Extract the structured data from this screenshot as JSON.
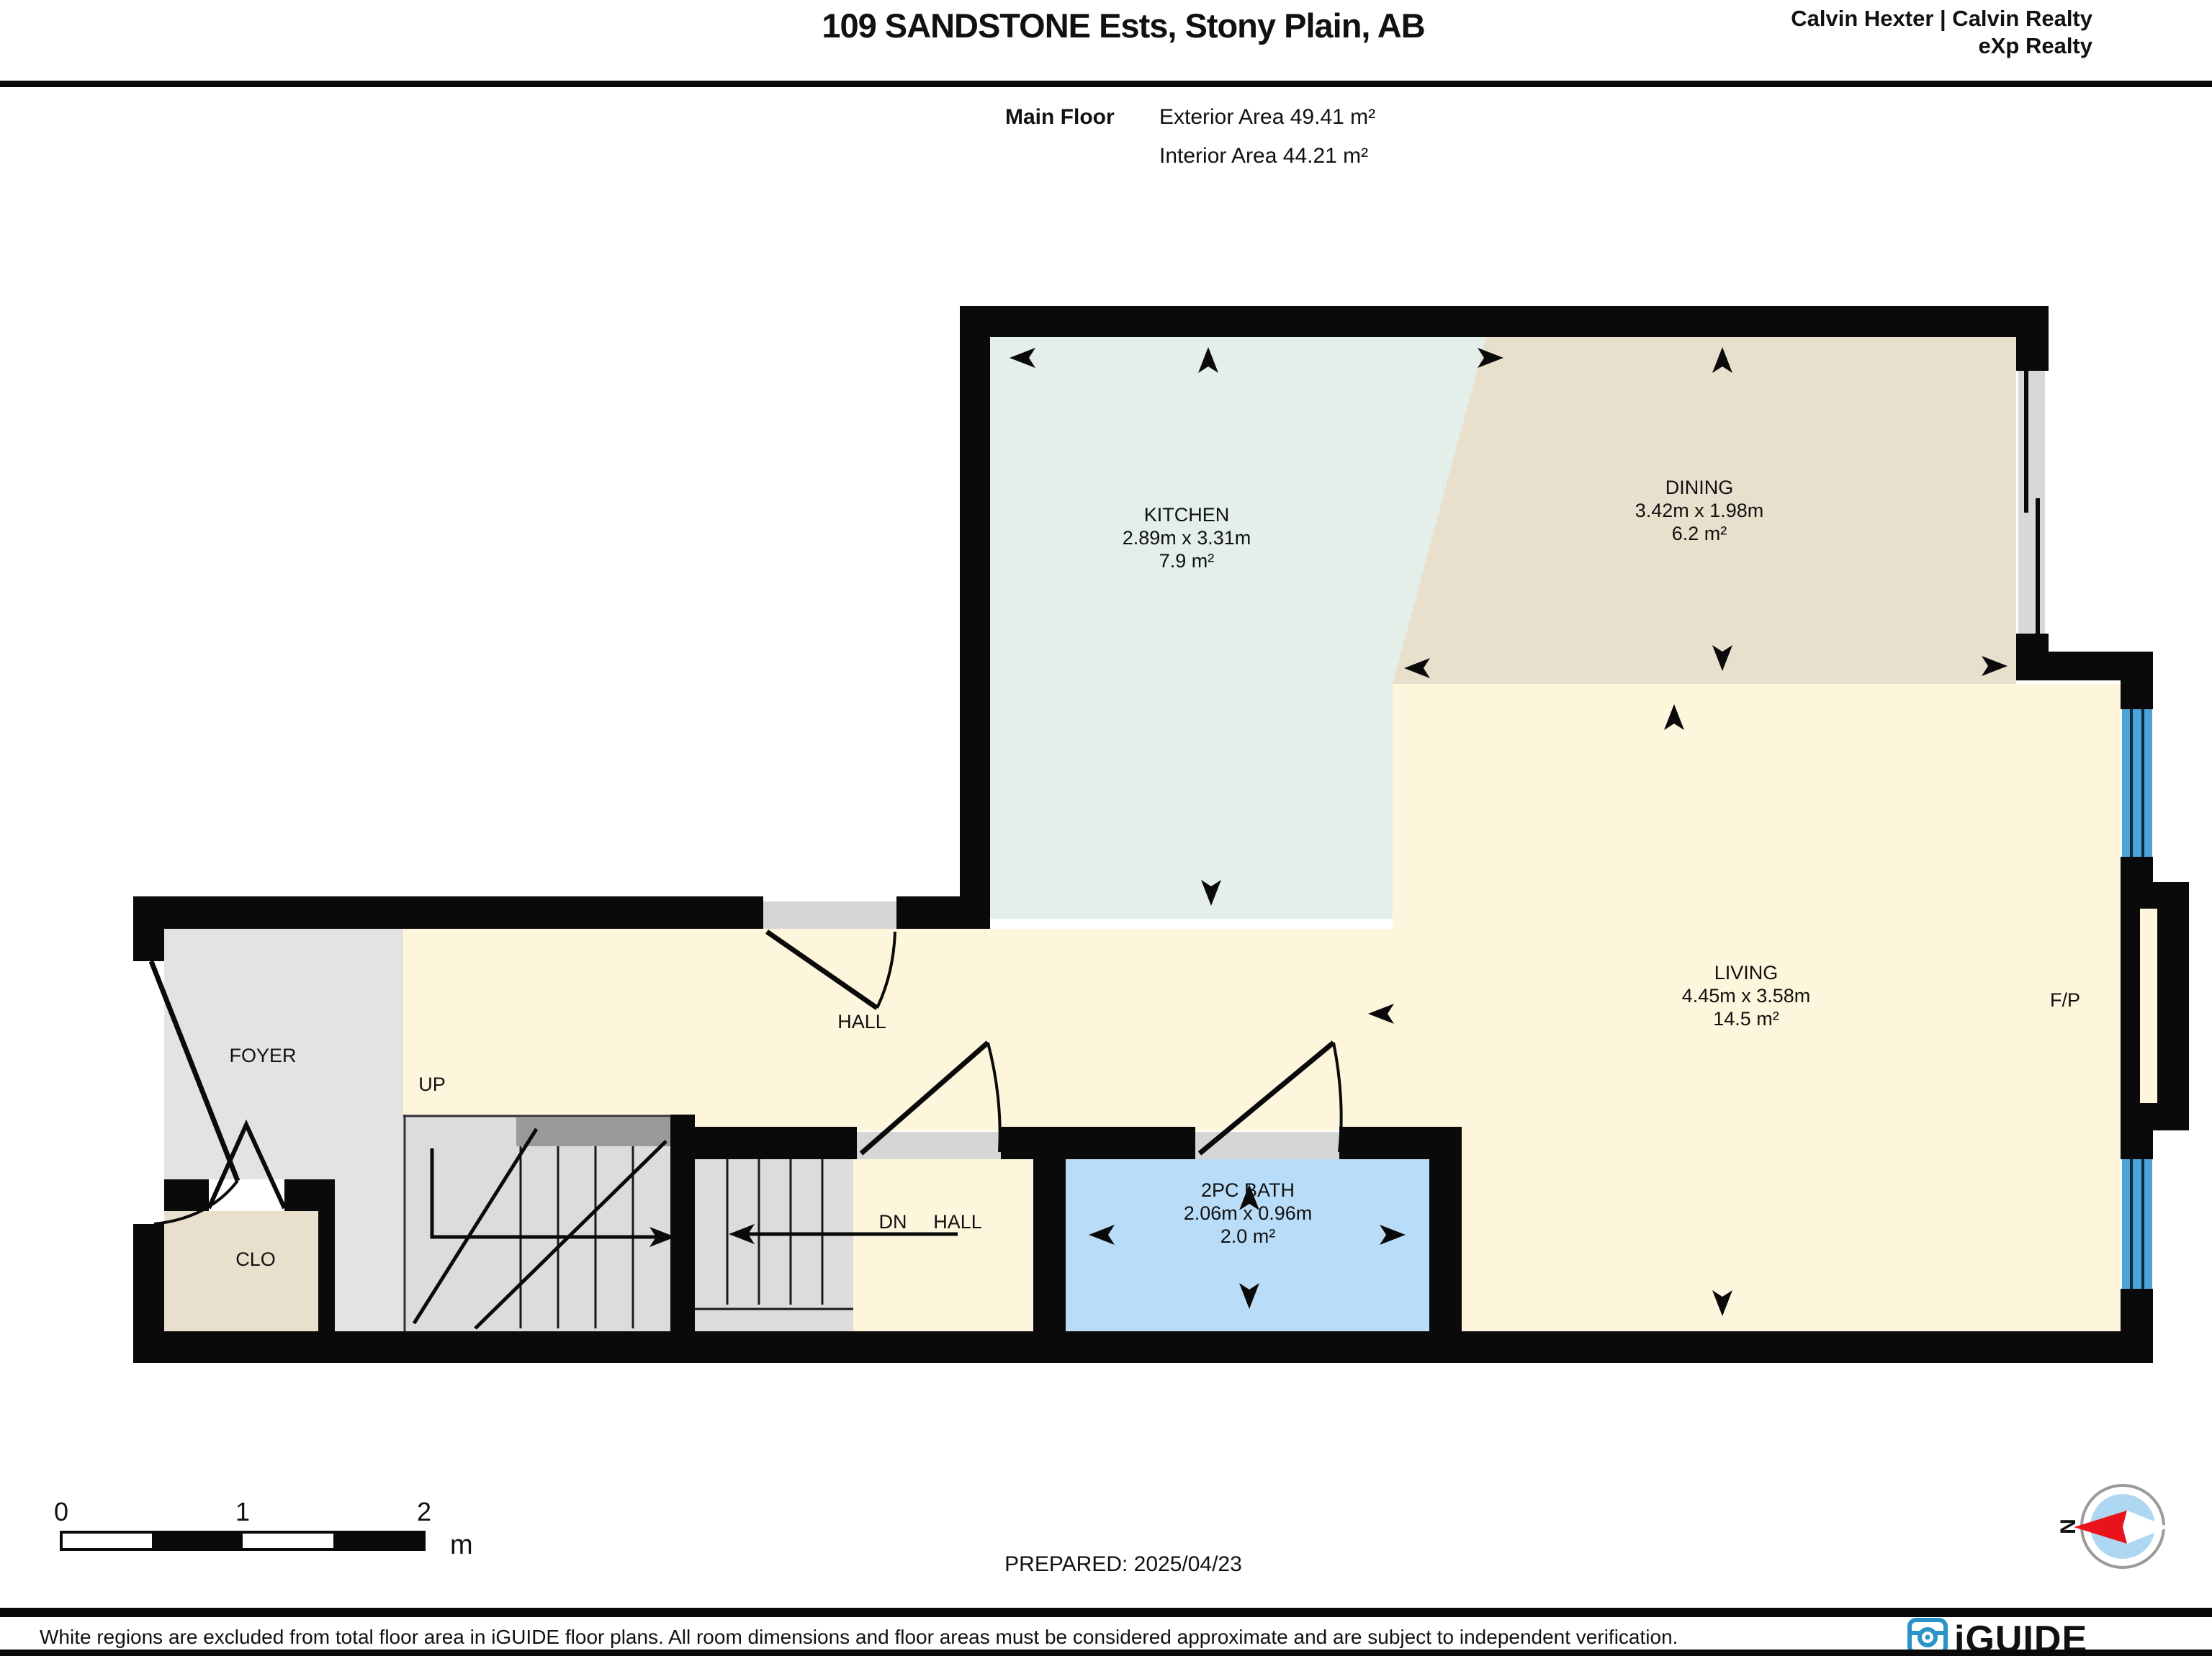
{
  "header": {
    "title": "109 SANDSTONE Ests, Stony Plain, AB",
    "agent_line1": "Calvin Hexter | Calvin Realty",
    "agent_line2": "eXp Realty",
    "floor_label": "Main Floor",
    "exterior_area": "Exterior Area 49.41 m²",
    "interior_area": "Interior Area 44.21 m²"
  },
  "rooms": {
    "kitchen": {
      "name": "KITCHEN",
      "dims": "2.89m x 3.31m",
      "area": "7.9 m²"
    },
    "dining": {
      "name": "DINING",
      "dims": "3.42m x 1.98m",
      "area": "6.2 m²"
    },
    "living": {
      "name": "LIVING",
      "dims": "4.45m x 3.58m",
      "area": "14.5 m²"
    },
    "bath": {
      "name": "2PC BATH",
      "dims": "2.06m x 0.96m",
      "area": "2.0 m²"
    }
  },
  "labels": {
    "hall": "HALL",
    "foyer": "FOYER",
    "up": "UP",
    "clo": "CLO",
    "dn": "DN",
    "dn_hall": "HALL",
    "fireplace": "F/P"
  },
  "scale_bar": {
    "ticks": [
      "0",
      "1",
      "2"
    ],
    "unit": "m"
  },
  "prepared_label": "PREPARED: 2025/04/23",
  "compass": {
    "north": "N"
  },
  "footer": {
    "disclaimer": "White regions are excluded from total floor area in iGUIDE floor plans. All room dimensions and floor areas must be considered approximate and are subject to independent verification.",
    "brand": "iGUIDE"
  },
  "colors": {
    "kitchen": "#e3efe8",
    "dining": "#e8dfcd",
    "living": "#fdf6dc",
    "bath": "#b9ddf8",
    "window": "#4da3d8",
    "foyer": "#e3e3e3",
    "stairs": "#dcdcdc",
    "rail": "#9a9a9a",
    "threshold": "#d6d6d6",
    "slider": "#d8d8d8",
    "wall": "#0a0a0a",
    "compass_red": "#e8131b",
    "compass_blue": "#aed7f2",
    "compass_ring": "#9a9a9a",
    "brand_blue": "#2a93c8"
  }
}
